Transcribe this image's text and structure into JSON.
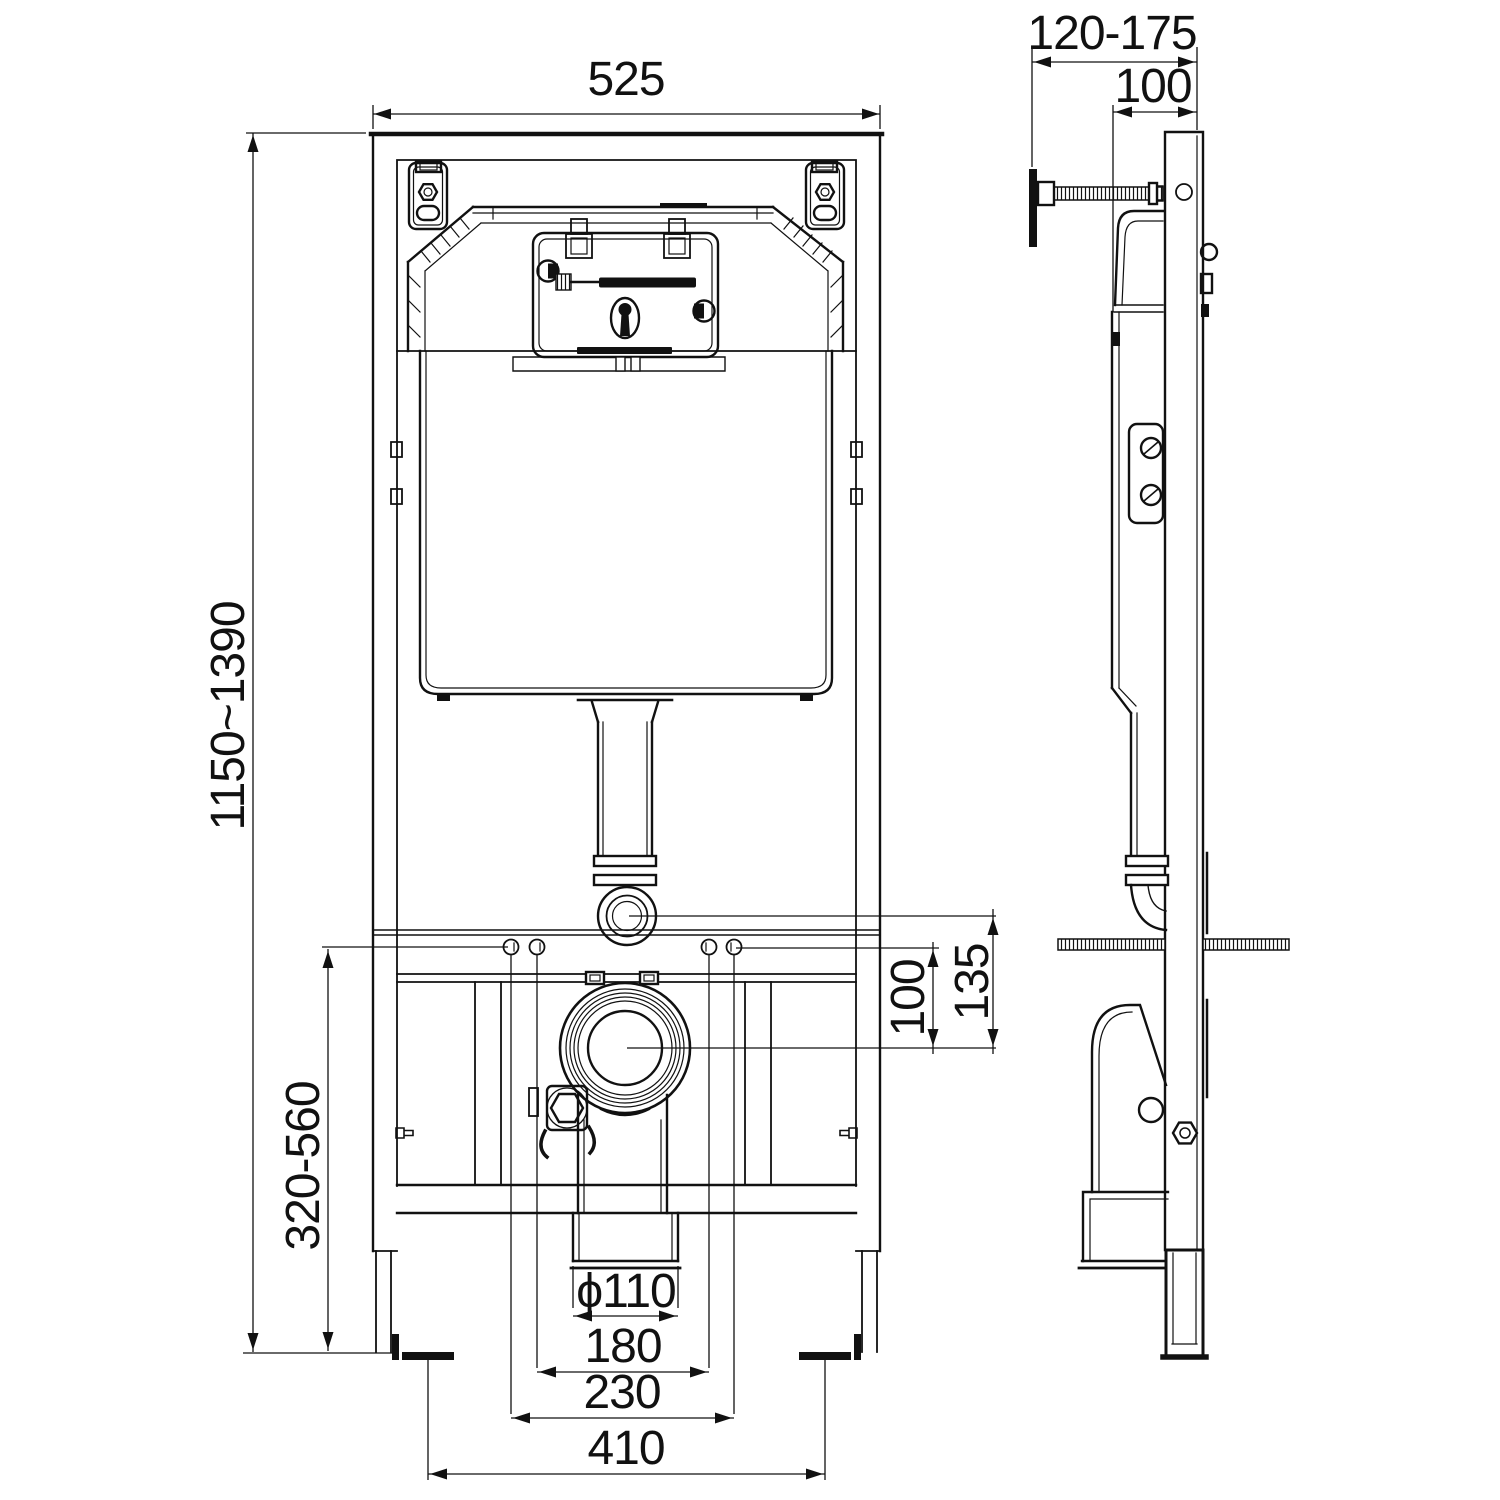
{
  "drawing": {
    "background": "#ffffff",
    "line_color": "#111111",
    "views": {
      "front": {
        "label": "front-elevation"
      },
      "side": {
        "label": "side-elevation"
      }
    },
    "dimensions": {
      "front_width": "525",
      "frame_height_range": "1150~1390",
      "outlet_height_range": "320-560",
      "fixing_to_drain_offset": "100",
      "flush_pipe_to_drain_offset": "135",
      "drain_pipe_diameter": "ϕ110",
      "pan_fixing_spacing": "180",
      "fixing_width": "230",
      "foot_spacing": "410",
      "wall_depth_range": "120-175",
      "frame_depth": "100"
    }
  }
}
